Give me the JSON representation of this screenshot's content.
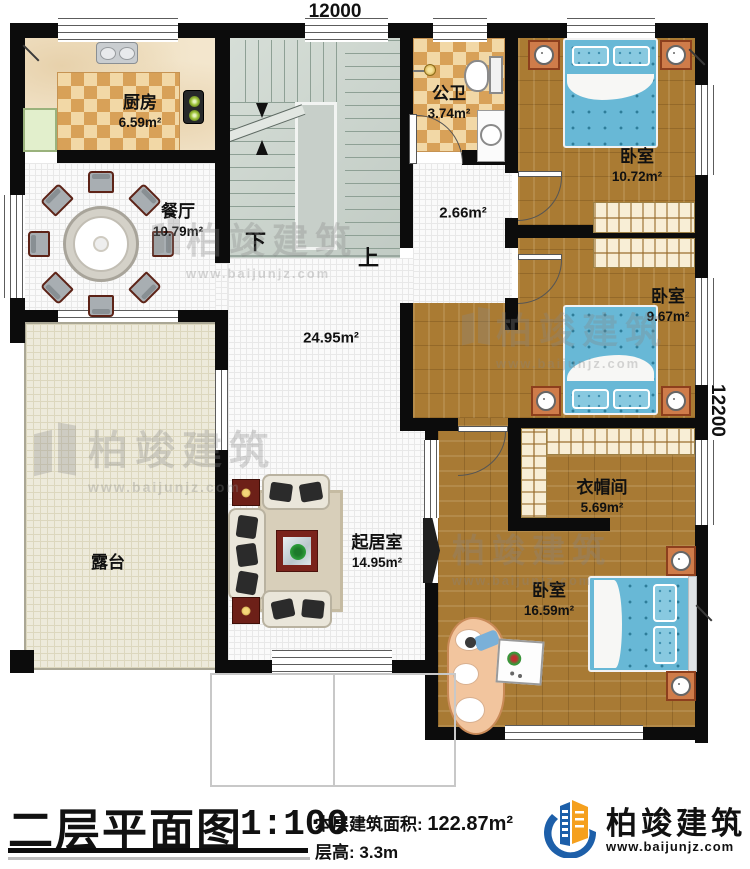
{
  "dimensions": {
    "width_top": "12000",
    "height_right": "12200"
  },
  "rooms": {
    "kitchen": {
      "name": "厨房",
      "area": "6.59m²"
    },
    "dining": {
      "name": "餐厅",
      "area": "10.79m²"
    },
    "bathroom": {
      "name": "公卫",
      "area": "3.74m²"
    },
    "bedroom_top": {
      "name": "卧室",
      "area": "10.72m²"
    },
    "corridor": {
      "area": "2.66m²"
    },
    "hall": {
      "area": "24.95m²"
    },
    "bedroom_mid": {
      "name": "卧室",
      "area": "9.67m²"
    },
    "cloakroom": {
      "name": "衣帽间",
      "area": "5.69m²"
    },
    "terrace": {
      "name": "露台"
    },
    "living": {
      "name": "起居室",
      "area": "14.95m²"
    },
    "bedroom_master": {
      "name": "卧室",
      "area": "16.59m²"
    }
  },
  "stairs": {
    "down_label": "下",
    "up_label": "上"
  },
  "watermark": {
    "brand": "柏竣建筑",
    "url": "www.baijunjz.com"
  },
  "footer": {
    "title": "二层平面图",
    "scale": "1:100",
    "area_label": "本层建筑面积:",
    "area_value": "122.87m²",
    "floor_height_label": "层高:",
    "floor_height_value": "3.3m",
    "brand": "柏竣建筑",
    "brand_url": "www.baijunjz.com"
  },
  "colors": {
    "wall": "#0c0c0c",
    "bed": "#68b8d6",
    "wood": "#aa7b33",
    "brand_blue": "#1d5fa9",
    "brand_orange": "#f5a01e"
  }
}
